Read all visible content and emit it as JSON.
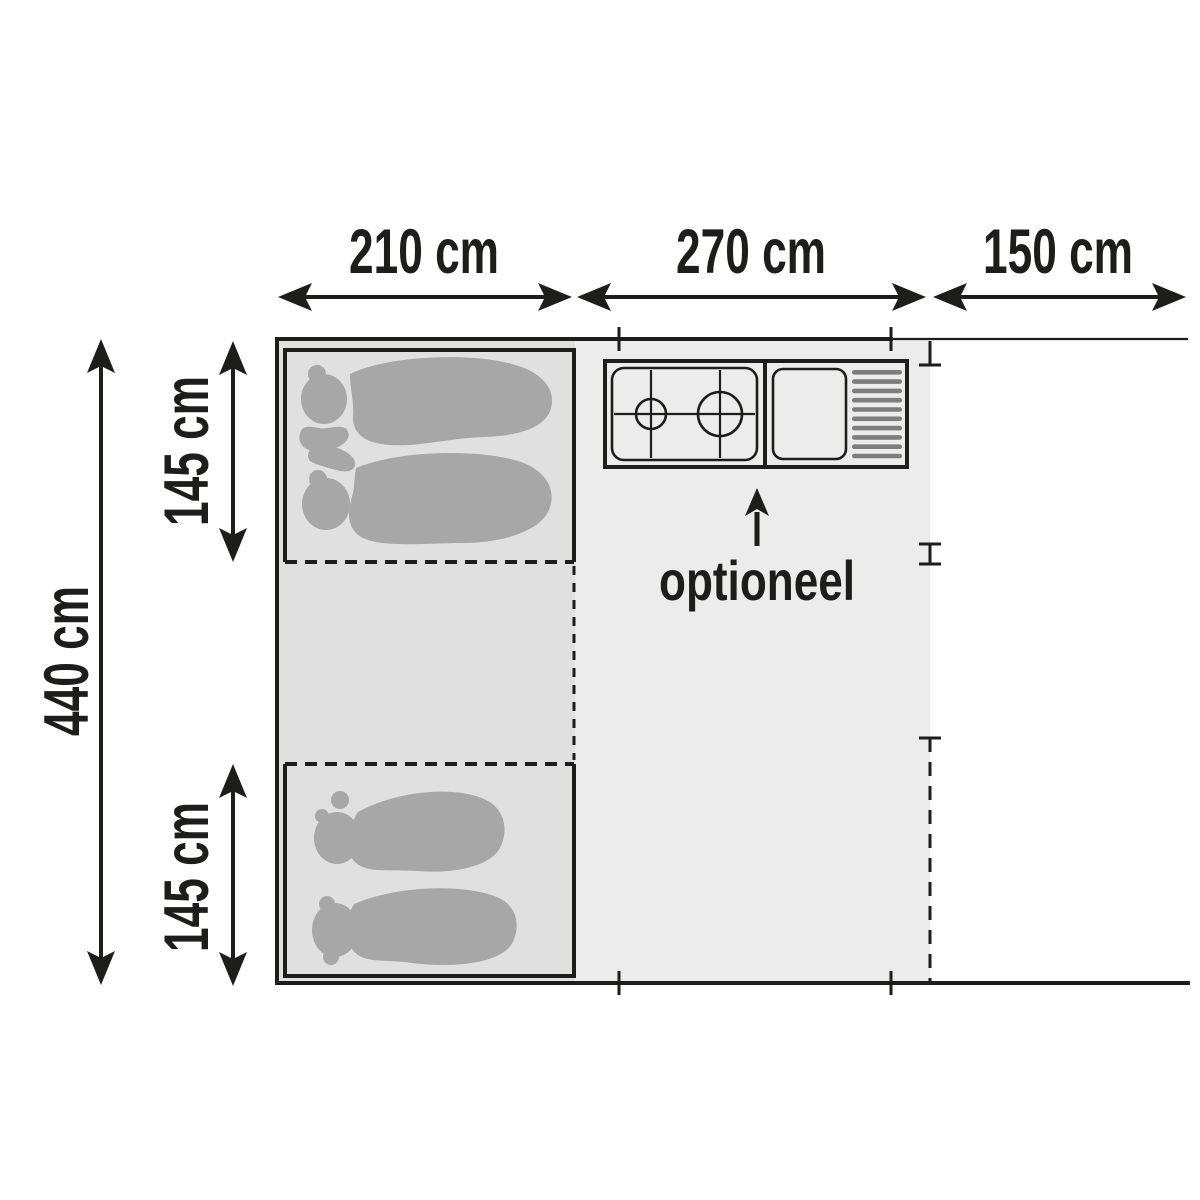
{
  "dimensions": {
    "top": [
      {
        "label": "210 cm"
      },
      {
        "label": "270 cm"
      },
      {
        "label": "150 cm"
      }
    ],
    "side": [
      {
        "label": "440 cm"
      },
      {
        "label": "145 cm"
      },
      {
        "label": "145 cm"
      }
    ]
  },
  "annotations": {
    "optional": "optioneel"
  },
  "colors": {
    "ink": "#1d1d1b",
    "living_area_fill": "#ececec",
    "cabin_column_fill": "#e0e0e0",
    "kitchen_frame_fill": "#d4d4d4",
    "kitchen_panel_fill": "#f4f4f4",
    "silhouette_fill": "#a7a7a7",
    "drainer_bar_fill": "#7d7d7d"
  }
}
